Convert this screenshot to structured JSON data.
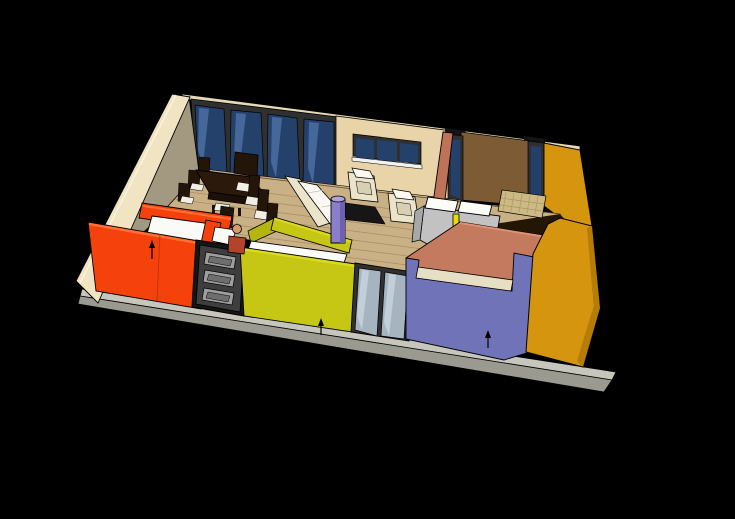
{
  "scene": {
    "description": "3D dollhouse-style rendering of a single-storey apartment viewed from a high front angle on a black background",
    "background": "#000000",
    "colors": {
      "background": "#000000",
      "slab_top": "#C6C6BC",
      "slab_face": "#9A9A90",
      "floor_wood": "#C9B185",
      "plank_line": "#8A6F4C",
      "exterior_cream": "#F1E4C2",
      "interior_taupe": "#A39880",
      "wall_top_strip": "#E6D9B6",
      "back_wall_tan": "#E8D4A8",
      "accent_brown": "#7D5B35",
      "lintel_dark": "#151515",
      "window_frame_dark": "#303030",
      "window_glass_navy": "#24416B",
      "window_glass_streak": "#46679A",
      "window_sill_white": "#F2F2EE",
      "front_glass": "#A6B4C0",
      "front_glass_streak": "#C3CFD8",
      "wall_orange": "#F5420C",
      "orange_highlight": "#FF7038",
      "orange_shade": "#C23406",
      "wall_chartreuse": "#C6C614",
      "chartreuse_highlight": "#DADA22",
      "chartreuse_shade": "#B5B50F",
      "wall_violet": "#7173B8",
      "violet_band_cream": "#E6DFC4",
      "wall_ochre": "#D6950F",
      "ochre_deep": "#B67C08",
      "wall_salmon": "#C47A5F",
      "salmon_highlight": "#DE9173",
      "salmon_partition": "#BE7257",
      "door_frame": "#151515",
      "door_leaf": "#3E3E3E",
      "door_panel_frame": "#9E9E9E",
      "door_panel_glass": "#6E6E6E",
      "table_wood": "#2B1A0C",
      "table_side": "#1C1006",
      "chair_wood": "#241509",
      "seat_cushion": "#F1EEE4",
      "sofa_cream": "#EBE4CA",
      "sofa_white": "#FAF8F0",
      "sofa_shadow": "#D8D0B4",
      "rug_dark": "#161616",
      "column_violet": "#8B7ECA",
      "column_shade": "#6E62AE",
      "column_top": "#AFA2E0",
      "bed_gray": "#C2C2C2",
      "bed_gray_side": "#A8A8A8",
      "pillow_white": "#FCFCF8",
      "lamp_yellow": "#E8DC00",
      "fixture_white": "#FAFAF6",
      "straw_floor": "#CDB982",
      "straw_line": "#A8966A",
      "shadow_floor": "#231604",
      "skin": "#D89B6E",
      "hair": "#2E2013",
      "shirt": "#B5422B",
      "arrow_black": "#000000"
    },
    "inventory": {
      "exterior": [
        "cream left wall",
        "gray foundation slab",
        "ochre right wall"
      ],
      "back_wall": [
        "bank of 4 navy floor-to-ceiling window panels",
        "tan wall with 3-pane window",
        "brown accent wall flanked by 2 tall navy windows"
      ],
      "front_walls": [
        "orange room pod with white fixture inside",
        "dark paneled entry door with 3 glazed panels",
        "chartreuse room pod with white counter band",
        "2-pane glazed front window",
        "violet wall with cream top band"
      ],
      "furniture": [
        "dark dining table with 7 dark chairs with white cushions",
        "dark upright panel at table head",
        "cream sofa",
        "2 cream armchairs",
        "dark rug",
        "violet cylinder column",
        "gray bed with 2 white pillows and yellow lamp",
        "large salmon panel",
        "straw mat strip"
      ],
      "figures": [
        "small person with dark hair and red shirt near entry door"
      ],
      "annotations": [
        "3 small black arrows on orange, chartreuse and violet walls"
      ]
    }
  }
}
